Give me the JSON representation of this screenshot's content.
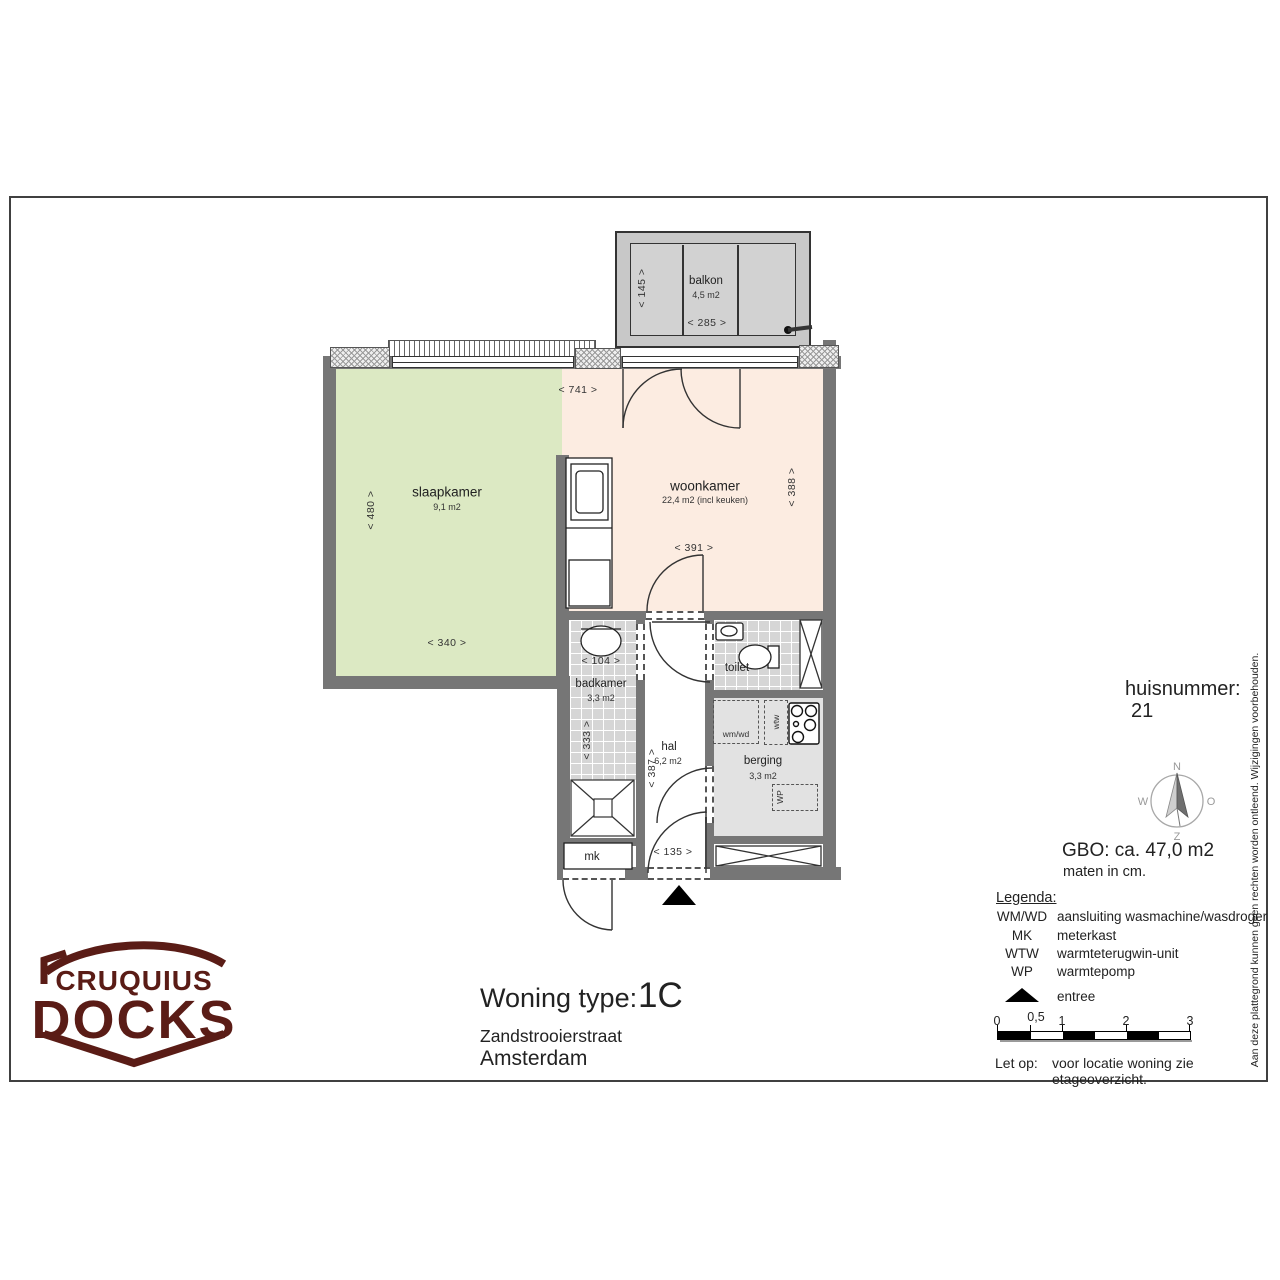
{
  "page": {
    "disclaimer": "Aan deze plattegrond kunnen geen rechten worden ontleend. Wijzigingen voorbehouden."
  },
  "logo": {
    "line1": "CRUQUIUS",
    "line2": "DOCKS",
    "color": "#5a1c16"
  },
  "title_block": {
    "type_label": "Woning type:",
    "type_value": "1C",
    "street": "Zandstrooierstraat",
    "city": "Amsterdam"
  },
  "info": {
    "huisnummer_label": "huisnummer:",
    "huisnummer_value": "21",
    "gbo": "GBO: ca. 47,0 m2",
    "units": "maten in cm.",
    "compass": {
      "n": "N",
      "o": "O",
      "z": "Z",
      "w": "W"
    }
  },
  "legend": {
    "heading": "Legenda:",
    "items": [
      {
        "abbr": "WM/WD",
        "desc": "aansluiting wasmachine/wasdroger"
      },
      {
        "abbr": "MK",
        "desc": "meterkast"
      },
      {
        "abbr": "WTW",
        "desc": "warmteterugwin-unit"
      },
      {
        "abbr": "WP",
        "desc": "warmtepomp"
      }
    ],
    "entree_label": "entree",
    "scale_ticks": [
      "0",
      "0,5",
      "1",
      "2",
      "3"
    ],
    "note_label": "Let op:",
    "note_text": "voor locatie woning zie etageoverzicht."
  },
  "rooms": {
    "balkon": {
      "name": "balkon",
      "area": "4,5 m2",
      "dim_w": "< 285 >",
      "dim_h": "< 145 >"
    },
    "slaapkamer": {
      "name": "slaapkamer",
      "area": "9,1 m2",
      "dim_w": "< 340 >",
      "dim_h": "< 480 >"
    },
    "woonkamer": {
      "name": "woonkamer",
      "area": "22,4 m2 (incl keuken)",
      "dim_top": "< 741 >",
      "dim_h": "< 388 >",
      "dim_door": "< 391 >"
    },
    "badkamer": {
      "name": "badkamer",
      "area": "3,3 m2",
      "dim_w": "< 104 >",
      "dim_h": "< 333 >"
    },
    "toilet": {
      "name": "toilet"
    },
    "hal": {
      "name": "hal",
      "area": "6,2 m2",
      "dim_h": "< 387 >",
      "dim_w": "< 135 >"
    },
    "berging": {
      "name": "berging",
      "area": "3,3 m2",
      "wmwd": "wm/wd",
      "wtw": "wtw",
      "wp": "WP"
    },
    "mk": {
      "name": "mk"
    }
  }
}
